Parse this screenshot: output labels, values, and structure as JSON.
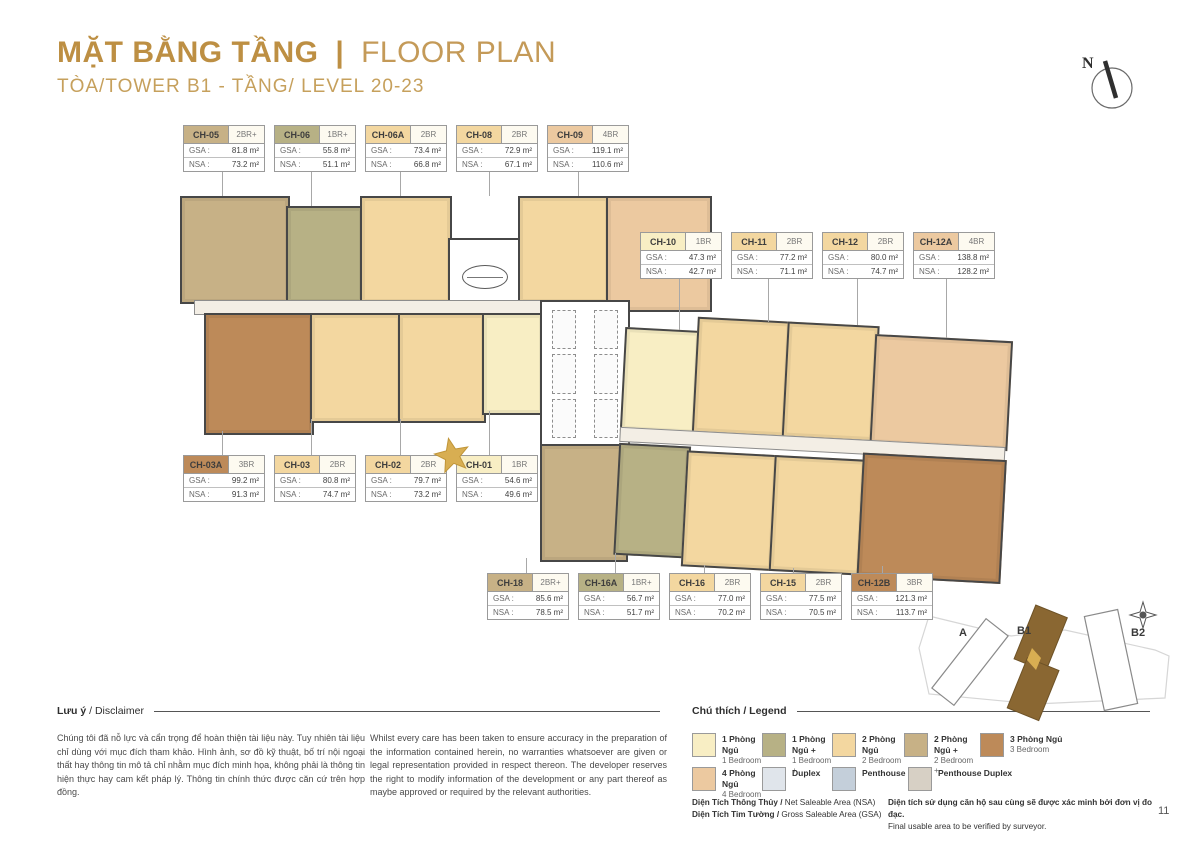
{
  "header": {
    "title_vi": "MẶT BẰNG TẦNG",
    "title_divider": "|",
    "title_en": "FLOOR PLAN",
    "subtitle": "TÒA/TOWER B1 - TẦNG/ LEVEL 20-23",
    "north_label": "N"
  },
  "label_fields": {
    "gsa": "GSA :",
    "nsa": "NSA :"
  },
  "unit_labels": {
    "top": [
      {
        "code": "CH-05",
        "type": "2BR+",
        "type_key": "2br_plus",
        "gsa": "81.8 m²",
        "nsa": "73.2 m²"
      },
      {
        "code": "CH-06",
        "type": "1BR+",
        "type_key": "1br_plus",
        "gsa": "55.8 m²",
        "nsa": "51.1 m²"
      },
      {
        "code": "CH-06A",
        "type": "2BR",
        "type_key": "2br",
        "gsa": "73.4 m²",
        "nsa": "66.8 m²"
      },
      {
        "code": "CH-08",
        "type": "2BR",
        "type_key": "2br",
        "gsa": "72.9 m²",
        "nsa": "67.1 m²"
      },
      {
        "code": "CH-09",
        "type": "4BR",
        "type_key": "4br",
        "gsa": "119.1 m²",
        "nsa": "110.6 m²"
      }
    ],
    "right": [
      {
        "code": "CH-10",
        "type": "1BR",
        "type_key": "1br",
        "gsa": "47.3 m²",
        "nsa": "42.7 m²"
      },
      {
        "code": "CH-11",
        "type": "2BR",
        "type_key": "2br",
        "gsa": "77.2 m²",
        "nsa": "71.1 m²"
      },
      {
        "code": "CH-12",
        "type": "2BR",
        "type_key": "2br",
        "gsa": "80.0 m²",
        "nsa": "74.7 m²"
      },
      {
        "code": "CH-12A",
        "type": "4BR",
        "type_key": "4br",
        "gsa": "138.8 m²",
        "nsa": "128.2 m²"
      }
    ],
    "middle": [
      {
        "code": "CH-03A",
        "type": "3BR",
        "type_key": "3br",
        "gsa": "99.2 m²",
        "nsa": "91.3 m²"
      },
      {
        "code": "CH-03",
        "type": "2BR",
        "type_key": "2br",
        "gsa": "80.8 m²",
        "nsa": "74.7 m²"
      },
      {
        "code": "CH-02",
        "type": "2BR",
        "type_key": "2br",
        "gsa": "79.7 m²",
        "nsa": "73.2 m²"
      },
      {
        "code": "CH-01",
        "type": "1BR",
        "type_key": "1br",
        "gsa": "54.6 m²",
        "nsa": "49.6 m²",
        "starred": true
      }
    ],
    "bottom": [
      {
        "code": "CH-18",
        "type": "2BR+",
        "type_key": "2br_plus",
        "gsa": "85.6 m²",
        "nsa": "78.5 m²"
      },
      {
        "code": "CH-16A",
        "type": "1BR+",
        "type_key": "1br_plus",
        "gsa": "56.7 m²",
        "nsa": "51.7 m²"
      },
      {
        "code": "CH-16",
        "type": "2BR",
        "type_key": "2br",
        "gsa": "77.0 m²",
        "nsa": "70.2 m²"
      },
      {
        "code": "CH-15",
        "type": "2BR",
        "type_key": "2br",
        "gsa": "77.5 m²",
        "nsa": "70.5 m²"
      },
      {
        "code": "CH-12B",
        "type": "3BR",
        "type_key": "3br",
        "gsa": "121.3 m²",
        "nsa": "113.7 m²"
      }
    ]
  },
  "palette": {
    "gold_title": "#bd8f43",
    "star": "#d8ae52",
    "site_b1_fill": "#8a6732",
    "unit_types": {
      "1br": "#f8eec4",
      "1br_plus": "#b7b185",
      "2br": "#f3d7a0",
      "2br_plus": "#c7b186",
      "3br": "#bd8a59",
      "4br": "#ecc9a0",
      "duplex": "#e0e5eb",
      "penthouse": "#c4cfda",
      "penthouse_duplex": "#d7d0c5"
    }
  },
  "disclaimer": {
    "heading_vi": "Lưu ý",
    "heading_rest": "/ Disclaimer",
    "text_vi": "Chúng tôi đã nỗ lực và cẩn trọng để hoàn thiện tài liệu này. Tuy nhiên tài liệu chỉ dùng với mục đích tham khảo. Hình ảnh, sơ đồ kỹ thuật, bố trí nội ngoại thất hay thông tin mô tả chỉ nhằm mục đích minh họa, không phải là thông tin hiện thực hay cam kết pháp lý. Thông tin chính thức được căn cứ trên hợp đồng.",
    "text_en": "Whilst every care has been taken to ensure accuracy in the preparation of the information contained herein, no warranties whatsoever are given or legal representation provided in respect thereon. The developer reserves the right to modify information of the development or any part thereof as maybe approved or required by the relevant authorities."
  },
  "legend": {
    "heading": "Chú thích / Legend",
    "items": [
      {
        "vi": "1 Phòng Ngủ",
        "en": "1 Bedroom",
        "type_key": "1br"
      },
      {
        "vi": "1 Phòng Ngủ +",
        "en": "1 Bedroom +",
        "type_key": "1br_plus"
      },
      {
        "vi": "2 Phòng Ngủ",
        "en": "2 Bedroom",
        "type_key": "2br"
      },
      {
        "vi": "2 Phòng Ngủ +",
        "en": "2 Bedroom +",
        "type_key": "2br_plus"
      },
      {
        "vi": "3 Phòng Ngủ",
        "en": "3 Bedroom",
        "type_key": "3br"
      },
      {
        "vi": "4 Phòng Ngủ",
        "en": "4 Bedroom",
        "type_key": "4br"
      },
      {
        "vi": "Duplex",
        "en": "",
        "type_key": "duplex"
      },
      {
        "vi": "Penthouse",
        "en": "",
        "type_key": "penthouse"
      },
      {
        "vi": "Penthouse Duplex",
        "en": "",
        "type_key": "penthouse_duplex"
      }
    ]
  },
  "area_notes": {
    "nsa_vi": "Diện Tích Thông Thủy /",
    "nsa_en": " Net Saleable Area (NSA)",
    "gsa_vi": "Diện Tích Tim Tường /",
    "gsa_en": " Gross Saleable Area (GSA)",
    "note_vi": "Diện tích sử dụng căn hộ sau cùng sẽ được xác minh bởi đơn vị đo đạc.",
    "note_en": "Final usable area to be verified by surveyor."
  },
  "site_map": {
    "towers": [
      {
        "label": "A",
        "highlighted": false
      },
      {
        "label": "B1",
        "highlighted": true
      },
      {
        "label": "B2",
        "highlighted": false
      }
    ]
  },
  "page_number": "11"
}
